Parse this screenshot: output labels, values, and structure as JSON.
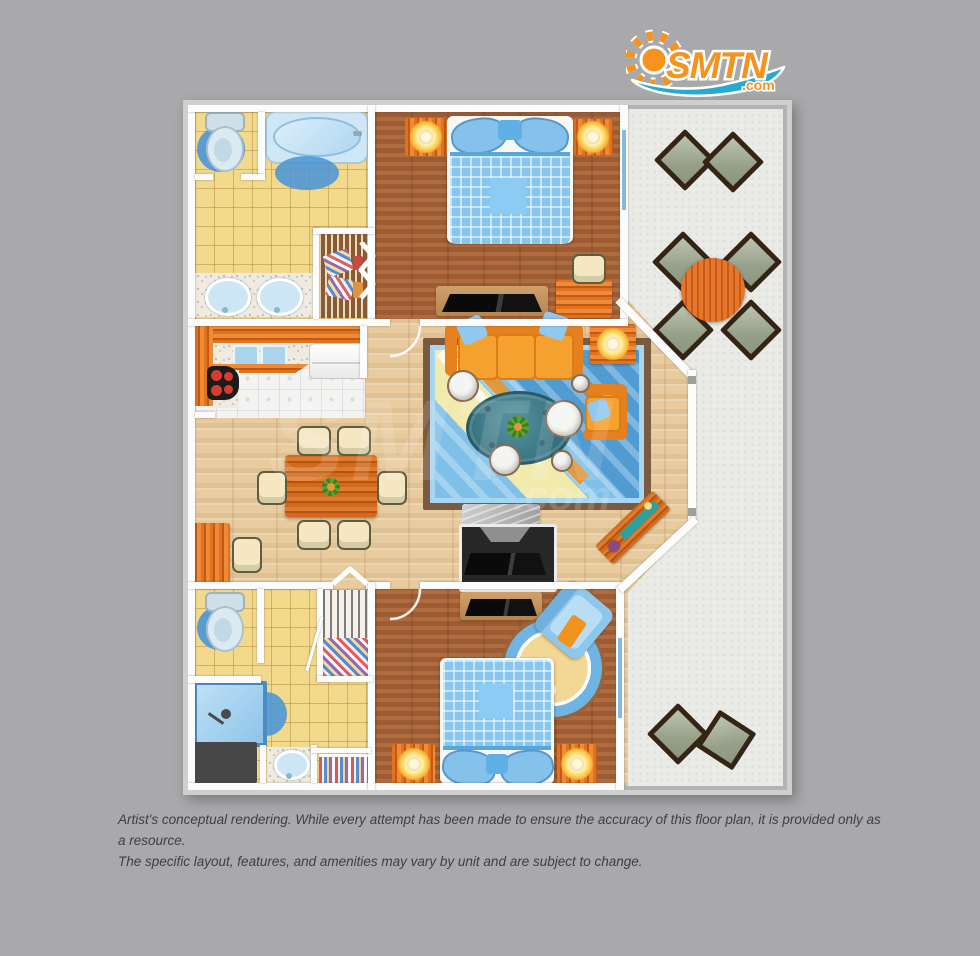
{
  "logo": {
    "brand": "SMTN",
    "tld": ".com",
    "brand_color": "#f6921e",
    "wave_color": "#2aa9cf",
    "sun_icon": "sun-icon"
  },
  "watermark": {
    "brand": "SMTN",
    "tld": ".com"
  },
  "disclaimer": {
    "line1": "Artist's conceptual rendering. While every attempt has been made to ensure the accuracy of this floor plan, it is provided only as a resource.",
    "line2": "The specific layout, features, and amenities may vary by unit and are subject to change."
  },
  "floor_plan": {
    "rooms": [
      {
        "name": "bathroom-1",
        "floor": "yellow-tile",
        "furniture": [
          "toilet",
          "bath-rug",
          "bathtub",
          "tub-mat",
          "double-sink-vanity",
          "linen-closet"
        ]
      },
      {
        "name": "bedroom-1",
        "floor": "dark-wood",
        "furniture": [
          "bed",
          "nightstand-lamp-left",
          "nightstand-lamp-right",
          "tv-console",
          "desk",
          "desk-chair",
          "balcony-window"
        ]
      },
      {
        "name": "kitchen",
        "floor": "white-tile",
        "furniture": [
          "l-shaped-counter",
          "double-sink",
          "stove",
          "refrigerator"
        ]
      },
      {
        "name": "dining-area",
        "floor": "light-wood",
        "furniture": [
          "dining-table",
          "dining-chairs-x6",
          "wall-desk",
          "chair"
        ]
      },
      {
        "name": "living-room",
        "floor": "light-wood",
        "furniture": [
          "sofa",
          "armchair",
          "area-rug",
          "coffee-table",
          "poufs",
          "side-table-lamp",
          "entertainment-center",
          "sideboard"
        ]
      },
      {
        "name": "bathroom-2",
        "floor": "yellow-tile",
        "furniture": [
          "toilet",
          "bath-rug",
          "shower",
          "utility-area",
          "vanity",
          "linen-closet",
          "wire-closet"
        ]
      },
      {
        "name": "bedroom-2",
        "floor": "dark-wood",
        "furniture": [
          "bed",
          "nightstand-lamp-left",
          "nightstand-lamp-right",
          "tv-console",
          "armchair",
          "round-rug",
          "balcony-window"
        ]
      },
      {
        "name": "balcony",
        "floor": "concrete",
        "furniture": [
          "patio-chair-pair-top",
          "patio-table",
          "patio-chairs-x4",
          "patio-chair-pair-bottom"
        ]
      }
    ]
  },
  "colors": {
    "page_background": "#a9a9ac",
    "dark_wood_floor": "#aa6539",
    "light_wood_floor": "#e8cb9e",
    "yellow_tile": "#f3d98c",
    "balcony_concrete": "#eaeae7",
    "wall": "#fcfcfc",
    "accent_orange": "#f29a2e",
    "accent_blue": "#7cc0ea",
    "rug_blue": "#4f97d6",
    "coffee_table_teal": "#35707e"
  }
}
